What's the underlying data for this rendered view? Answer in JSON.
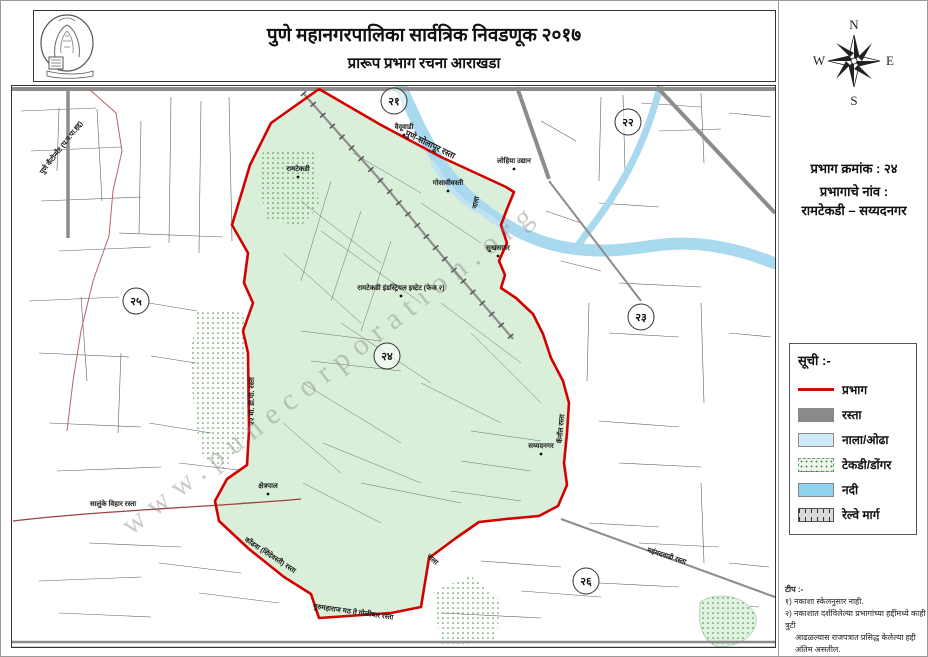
{
  "header": {
    "title": "पुणे महानगरपालिका सार्वत्रिक निवडणूक २०१७",
    "subtitle": "प्रारूप प्रभाग रचना आराखडा",
    "logo": "pmc-seal"
  },
  "sidebar": {
    "compass": {
      "n": "N",
      "e": "E",
      "s": "S",
      "w": "W"
    },
    "ward_number_label": "प्रभाग क्रमांक : २४",
    "ward_name_label": "प्रभागाचे नांव :",
    "ward_name": "रामटेकडी – सय्यदनगर",
    "legend": {
      "title": "सूची :-",
      "items": [
        {
          "label": "प्रभाग",
          "swatch": "red-line",
          "color": "#cc1100"
        },
        {
          "label": "रस्ता",
          "swatch": "solid",
          "color": "#8a8a8a"
        },
        {
          "label": "नाला/ओढा",
          "swatch": "solid",
          "color": "#cfe9f8"
        },
        {
          "label": "टेकडी/डोंगर",
          "swatch": "dotted",
          "color": "#eef6ee"
        },
        {
          "label": "नदी",
          "swatch": "solid",
          "color": "#8fd4ef"
        },
        {
          "label": "रेल्वे मार्ग",
          "swatch": "railway",
          "color": "#d9d9d9"
        }
      ]
    },
    "notes": {
      "title": "टीप :-",
      "lines": [
        "१) नकाशा स्केलनुसार नाही.",
        "२) नकाशात दर्शविलेल्या प्रभागांच्या हद्दींमध्ये काही त्रुटी",
        "आढळल्यास राजपत्रात प्रसिद्ध केलेल्या हद्दी अंतिम असतील."
      ]
    }
  },
  "map": {
    "watermark": "www.punecorporation.org",
    "colors": {
      "ward_fill": "#d9efd9",
      "ward_border": "#d40000",
      "river": "#a9d9ee",
      "road": "#8c8c8c",
      "street": "#606060"
    },
    "ward_circles": [
      {
        "num": "२१",
        "x": 393,
        "y": 100
      },
      {
        "num": "२२",
        "x": 627,
        "y": 121
      },
      {
        "num": "२३",
        "x": 640,
        "y": 316
      },
      {
        "num": "२४",
        "x": 386,
        "y": 355
      },
      {
        "num": "२५",
        "x": 135,
        "y": 300
      },
      {
        "num": "२६",
        "x": 585,
        "y": 580
      }
    ],
    "labels": [
      {
        "text": "पुणे कॅंटोन्मेंट (प.न.पा.हद्द)",
        "x": 62,
        "y": 148,
        "rotate": -52
      },
      {
        "text": "पुणे-सोलापूर रस्ता",
        "x": 428,
        "y": 146,
        "rotate": 26,
        "size": "big"
      },
      {
        "text": "वैदूवाडी",
        "x": 403,
        "y": 128,
        "dot": true
      },
      {
        "text": "रामटेकडी",
        "x": 297,
        "y": 170,
        "dot": true
      },
      {
        "text": "गोसावीवस्ती",
        "x": 447,
        "y": 184,
        "dot": true
      },
      {
        "text": "लोहिया उद्यान",
        "x": 513,
        "y": 162,
        "dot": true
      },
      {
        "text": "नाला",
        "x": 477,
        "y": 202,
        "rotate": -78
      },
      {
        "text": "सुखसागर",
        "x": 497,
        "y": 249,
        "dot": true
      },
      {
        "text": "रामटेकडी इंडस्ट्रियल इस्टेट (फेज २)",
        "x": 400,
        "y": 289,
        "dot": true
      },
      {
        "text": "२२ मी. डी.पी. रस्ता",
        "x": 253,
        "y": 400,
        "rotate": -90
      },
      {
        "text": "सय्यदनगर",
        "x": 540,
        "y": 447,
        "dot": true
      },
      {
        "text": "कॅनॉल रस्ता",
        "x": 562,
        "y": 428,
        "rotate": -85
      },
      {
        "text": "क्षेत्रपाल",
        "x": 267,
        "y": 487,
        "dot": true
      },
      {
        "text": "सालुंके विहार रस्ता",
        "x": 112,
        "y": 505
      },
      {
        "text": "कोंढवा (शिंदेवस्ती) रस्ता",
        "x": 268,
        "y": 556,
        "rotate": 33
      },
      {
        "text": "नाला",
        "x": 430,
        "y": 560,
        "rotate": 42
      },
      {
        "text": "गुरुमहाराज मठ ते गोळीबार रस्ता",
        "x": 352,
        "y": 613,
        "rotate": 8
      },
      {
        "text": "महंमदवाडी रस्ता",
        "x": 665,
        "y": 557,
        "rotate": 18
      }
    ]
  }
}
